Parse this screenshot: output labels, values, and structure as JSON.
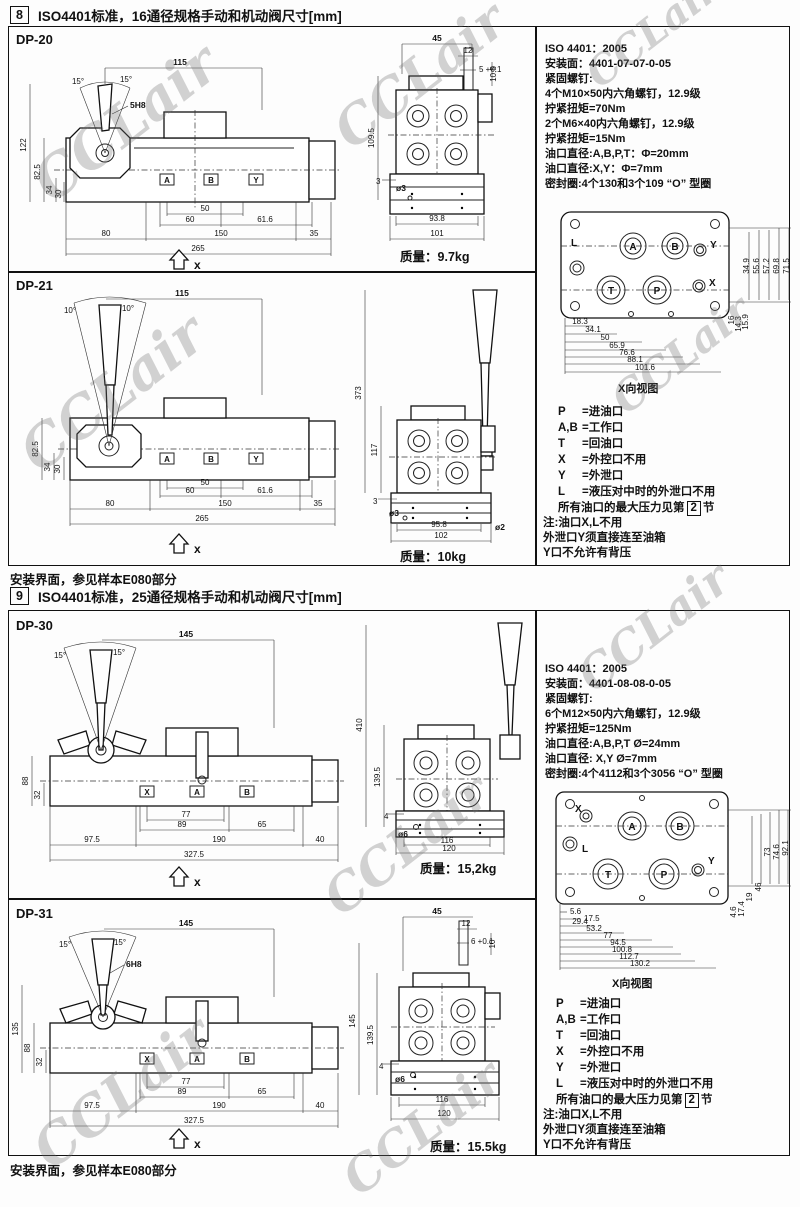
{
  "watermark": {
    "text": "CCLair",
    "color": "#c0c0c0"
  },
  "s8": {
    "num": "8",
    "title": "ISO4401标准，16通径规格手动和机动阀尺寸[mm]",
    "footer": "安装界面，参见样本E080部分",
    "mass_label": "质量：",
    "info": [
      "ISO 4401：2005",
      "安装面：4401-07-07-0-05",
      "紧固螺钉:",
      "4个M10×50内六角螺钉，12.9级",
      "拧紧扭矩=70Nm",
      "2个M6×40内六角螺钉，12.9级",
      "拧紧扭矩=15Nm",
      "油口直径:A,B,P,T：Φ=20mm",
      "油口直径:X,Y：Φ=7mm",
      "密封圈:4个130和3个109 “O” 型圈"
    ],
    "dp20": {
      "label": "DP-20",
      "mass": "9.7kg",
      "angle_l": "15°",
      "angle_r": "15°",
      "pin": "5H8",
      "axis": "x",
      "dim_top": "115",
      "v": [
        "122",
        "82.5",
        "34",
        "30"
      ],
      "inner": [
        "50",
        "60",
        "61.6"
      ],
      "bottom": [
        "80",
        "150",
        "35"
      ],
      "total": "265",
      "ports": [
        "A",
        "B",
        "Y"
      ],
      "end": {
        "d1": "45",
        "d2": "12",
        "d3": "5 +0.1",
        "vr": "10.5",
        "vl": "109.5",
        "hole": "ø3",
        "s": "3",
        "w1": "93.8",
        "w2": "101"
      }
    },
    "dp21": {
      "label": "DP-21",
      "mass": "10kg",
      "angle_l": "10°",
      "angle_r": "10°",
      "axis": "x",
      "dim_top": "115",
      "v": [
        "82.5",
        "34",
        "30"
      ],
      "inner": [
        "50",
        "60",
        "61.6"
      ],
      "bottom": [
        "80",
        "150",
        "35"
      ],
      "total": "265",
      "ports": [
        "A",
        "B",
        "Y"
      ],
      "end": {
        "v1": "373",
        "v2": "117",
        "s": "3",
        "hole": "ø3",
        "w1": "95.8",
        "hole2": "ø2",
        "w2": "102"
      }
    },
    "face": {
      "caption": "X向视图",
      "ports": {
        "l": "L",
        "a": "A",
        "b": "B",
        "y": "Y",
        "x": "X",
        "t": "T",
        "p": "P"
      },
      "h": [
        "18.3",
        "34.1",
        "50",
        "65.9",
        "76.6",
        "88.1",
        "101.6"
      ],
      "v": [
        "16",
        "14.3",
        "15.9",
        "34.9",
        "55.6",
        "57.2",
        "69.8",
        "71.5"
      ]
    },
    "legend": {
      "items": [
        {
          "k": "P",
          "d": "=进油口"
        },
        {
          "k": "A,B",
          "d": "=工作口"
        },
        {
          "k": "T",
          "d": "=回油口"
        },
        {
          "k": "X",
          "d": "=外控口不用"
        },
        {
          "k": "Y",
          "d": "=外泄口"
        },
        {
          "k": "L",
          "d": "=液压对中时的外泄口不用"
        }
      ],
      "max_prefix": "所有油口的最大压力见第",
      "max_box": "2",
      "max_suffix": "节"
    },
    "note": [
      "注:油口X,L不用",
      "外泄口Y须直接连至油箱",
      "Y口不允许有背压"
    ]
  },
  "s9": {
    "num": "9",
    "title": "ISO4401标准，25通径规格手动和机动阀尺寸[mm]",
    "footer": "安装界面，参见样本E080部分",
    "mass_label": "质量：",
    "info": [
      "ISO 4401：2005",
      "安装面：4401-08-08-0-05",
      "紧固螺钉:",
      "6个M12×50内六角螺钉，12.9级",
      "拧紧扭矩=125Nm",
      "油口直径:A,B,P,T Ø=24mm",
      "油口直径: X,Y Ø=7mm",
      "密封圈:4个4112和3个3056 “O” 型圈"
    ],
    "dp30": {
      "label": "DP-30",
      "mass": "15,2kg",
      "angle_l": "15°",
      "angle_r": "15°",
      "axis": "x",
      "dim_top": "145",
      "v": [
        "88",
        "32"
      ],
      "inner": [
        "77",
        "89",
        "65"
      ],
      "bottom": [
        "97.5",
        "190",
        "40"
      ],
      "total": "327.5",
      "ports": [
        "X",
        "A",
        "B"
      ],
      "end": {
        "v1": "410",
        "v2": "139.5",
        "s": "4",
        "hole": "ø6",
        "w1": "116",
        "w2": "120"
      }
    },
    "dp31": {
      "label": "DP-31",
      "mass": "15.5kg",
      "angle_l": "15°",
      "angle_r": "15°",
      "pin": "6H8",
      "axis": "x",
      "dim_top": "145",
      "v": [
        "135",
        "88",
        "32"
      ],
      "inner": [
        "77",
        "89",
        "65"
      ],
      "bottom": [
        "97.5",
        "190",
        "40"
      ],
      "total": "327.5",
      "ports": [
        "X",
        "A",
        "B"
      ],
      "end": {
        "d1": "45",
        "d2": "12",
        "d3": "6 +0.1",
        "vr": "10",
        "v1": "145",
        "v2": "139.5",
        "s": "4",
        "hole": "ø6",
        "w1": "116",
        "w2": "120"
      }
    },
    "face": {
      "caption": "X向视图",
      "ports": {
        "x": "X",
        "a": "A",
        "b": "B",
        "l": "L",
        "t": "T",
        "p": "P",
        "y": "Y"
      },
      "h": [
        "5.6",
        "17.5",
        "29.4",
        "53.2",
        "77",
        "94.5",
        "100.8",
        "112.7",
        "130.2"
      ],
      "v": [
        "4.6",
        "17.4",
        "19",
        "46",
        "73",
        "74.6",
        "92.1"
      ]
    },
    "legend": {
      "items": [
        {
          "k": "P",
          "d": "=进油口"
        },
        {
          "k": "A,B",
          "d": "=工作口"
        },
        {
          "k": "T",
          "d": "=回油口"
        },
        {
          "k": "X",
          "d": "=外控口不用"
        },
        {
          "k": "Y",
          "d": "=外泄口"
        },
        {
          "k": "L",
          "d": "=液压对中时的外泄口不用"
        }
      ],
      "max_prefix": "所有油口的最大压力见第",
      "max_box": "2",
      "max_suffix": "节"
    },
    "note": [
      "注:油口X,L不用",
      "外泄口Y须直接连至油箱",
      "Y口不允许有背压"
    ]
  }
}
